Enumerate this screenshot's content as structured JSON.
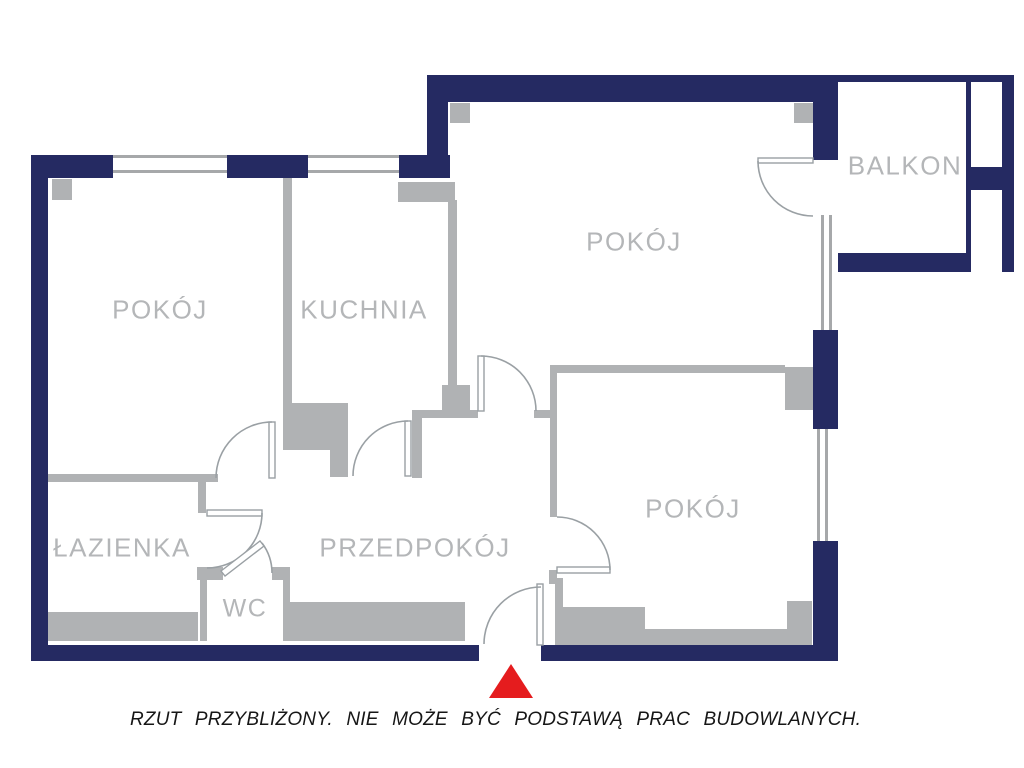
{
  "plan": {
    "title": "apartment-floor-plan",
    "rooms": [
      {
        "key": "pokoj_left",
        "label": "POKÓJ"
      },
      {
        "key": "kuchnia",
        "label": "KUCHNIA"
      },
      {
        "key": "pokoj_top",
        "label": "POKÓJ"
      },
      {
        "key": "balkon",
        "label": "BALKON"
      },
      {
        "key": "lazienka",
        "label": "ŁAZIENKA"
      },
      {
        "key": "przedpokoj",
        "label": "PRZEDPOKÓJ"
      },
      {
        "key": "wc",
        "label": "WC"
      },
      {
        "key": "pokoj_bottom",
        "label": "POKÓJ"
      }
    ],
    "caption": "RZUT PRZYBLIŻONY. NIE MOŻE BYĆ PODSTAWĄ PRAC BUDOWLANYCH.",
    "colors": {
      "exterior_wall": "#252a62",
      "interior_wall": "#b0b2b4",
      "window_line": "#a6a8aa",
      "door_arc": "#9aa0a4",
      "label_text": "#b4b6b8",
      "entrance_marker": "#e51c1e",
      "caption_text": "#161616"
    }
  }
}
